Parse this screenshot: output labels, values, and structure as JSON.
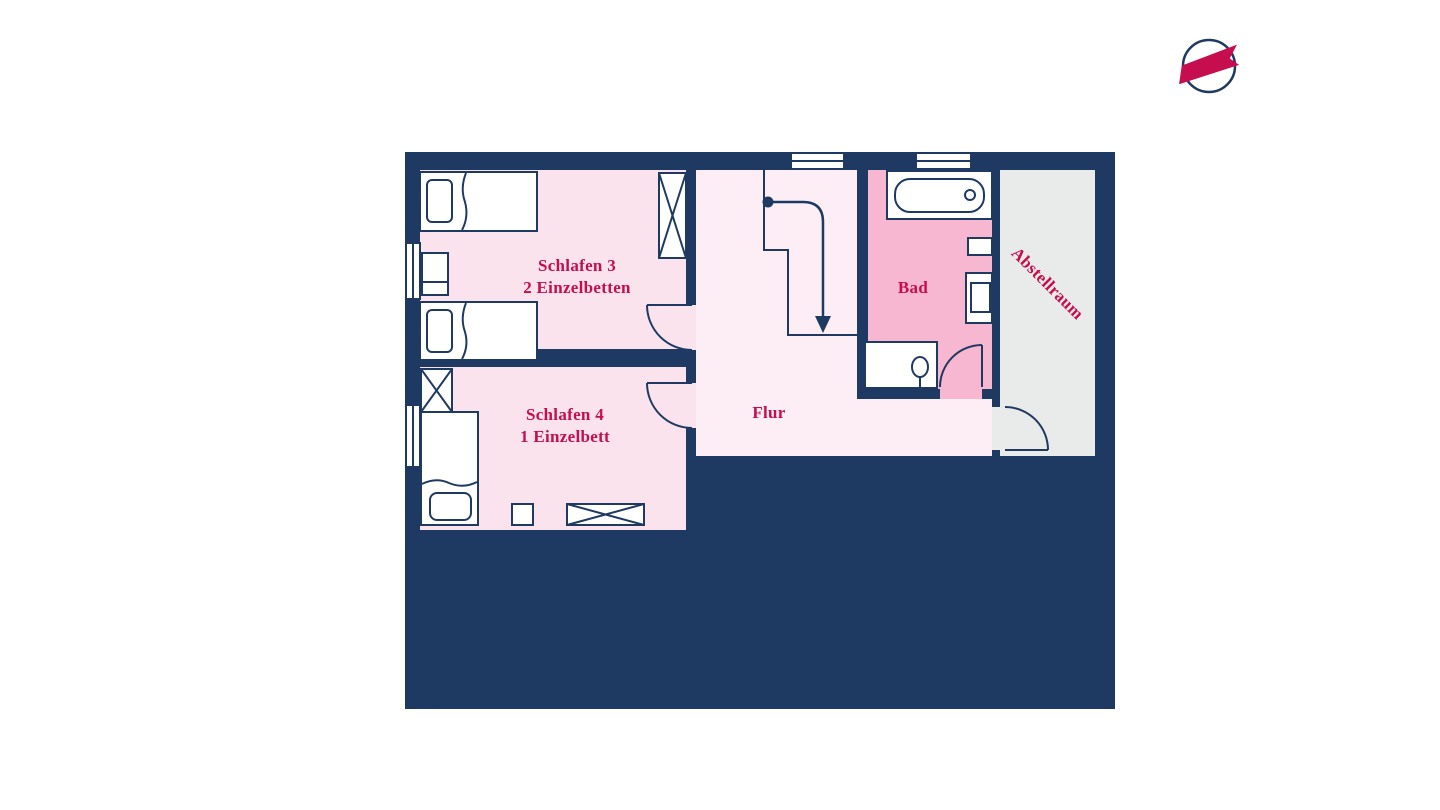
{
  "page": {
    "background": "#ffffff"
  },
  "logo": {
    "name": "brand-logo",
    "ring_color": "#1f3a62",
    "banner_color": "#c60d4e"
  },
  "colors": {
    "wall": "#1f3a62",
    "furniture_outline": "#1f3a62",
    "furniture_fill": "#ffffff",
    "label": "#c60d4e"
  },
  "floorplan": {
    "rooms": {
      "schlafen3": {
        "title": "Schlafen 3",
        "subtitle": "2 Einzelbetten",
        "fill": "#fbe3ed"
      },
      "schlafen4": {
        "title": "Schlafen 4",
        "subtitle": "1 Einzelbett",
        "fill": "#fbe3ed"
      },
      "flur": {
        "title": "Flur",
        "fill": "#fceef4"
      },
      "bad": {
        "title": "Bad",
        "fill": "#f8b7d0"
      },
      "abstellraum": {
        "title": "Abstellraum",
        "fill": "#e9eaea"
      }
    }
  }
}
